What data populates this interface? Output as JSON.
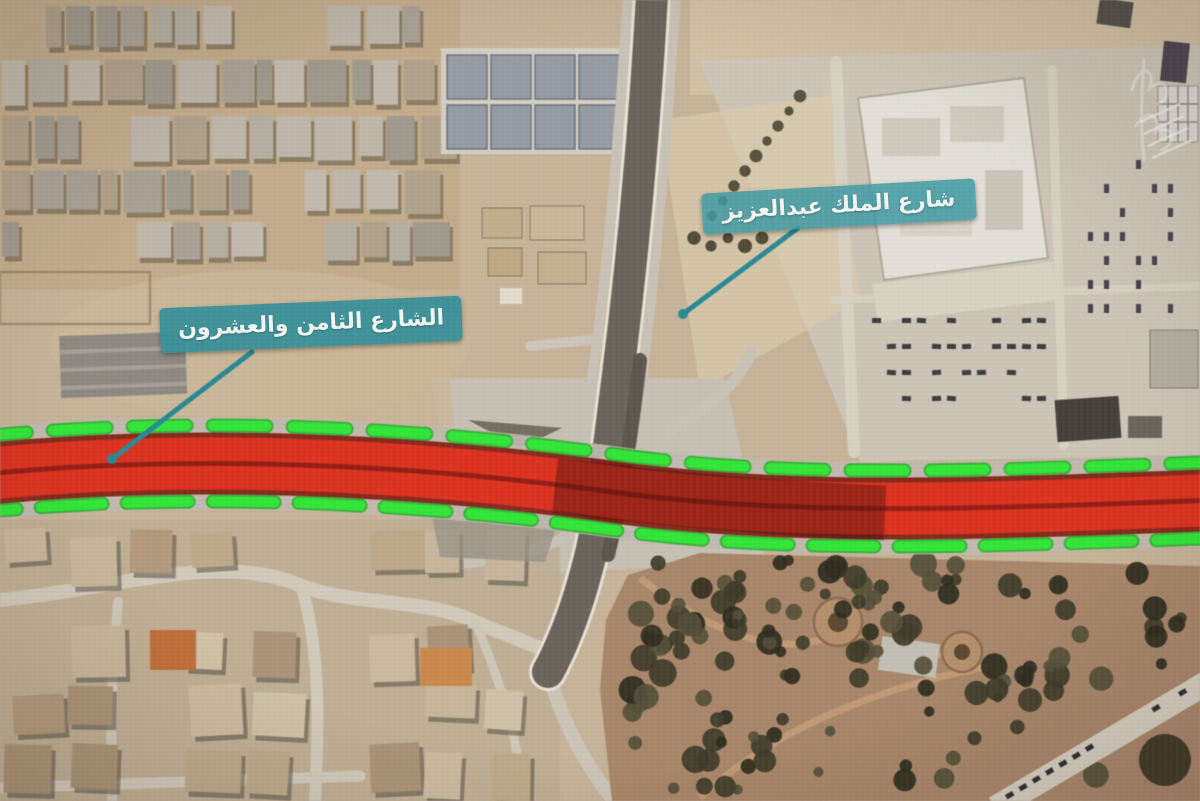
{
  "map": {
    "kind": "satellite-annotation-frame",
    "labels": [
      {
        "id": "king-abdulaziz-road",
        "text": "شارع الملك عبدالعزيز"
      },
      {
        "id": "twenty-eighth-street",
        "text": "الشارع الثامن والعشرون"
      }
    ],
    "colors": {
      "label-bg": "#3e969e",
      "label-text": "#f2f6f4",
      "leader": "#2b8a94",
      "corridor-red": "#d93321",
      "corridor-dark-red": "#7e1b11",
      "dash-green": "#35e53a",
      "asphalt": "#6b645c",
      "sand": "#c7b49a"
    }
  }
}
